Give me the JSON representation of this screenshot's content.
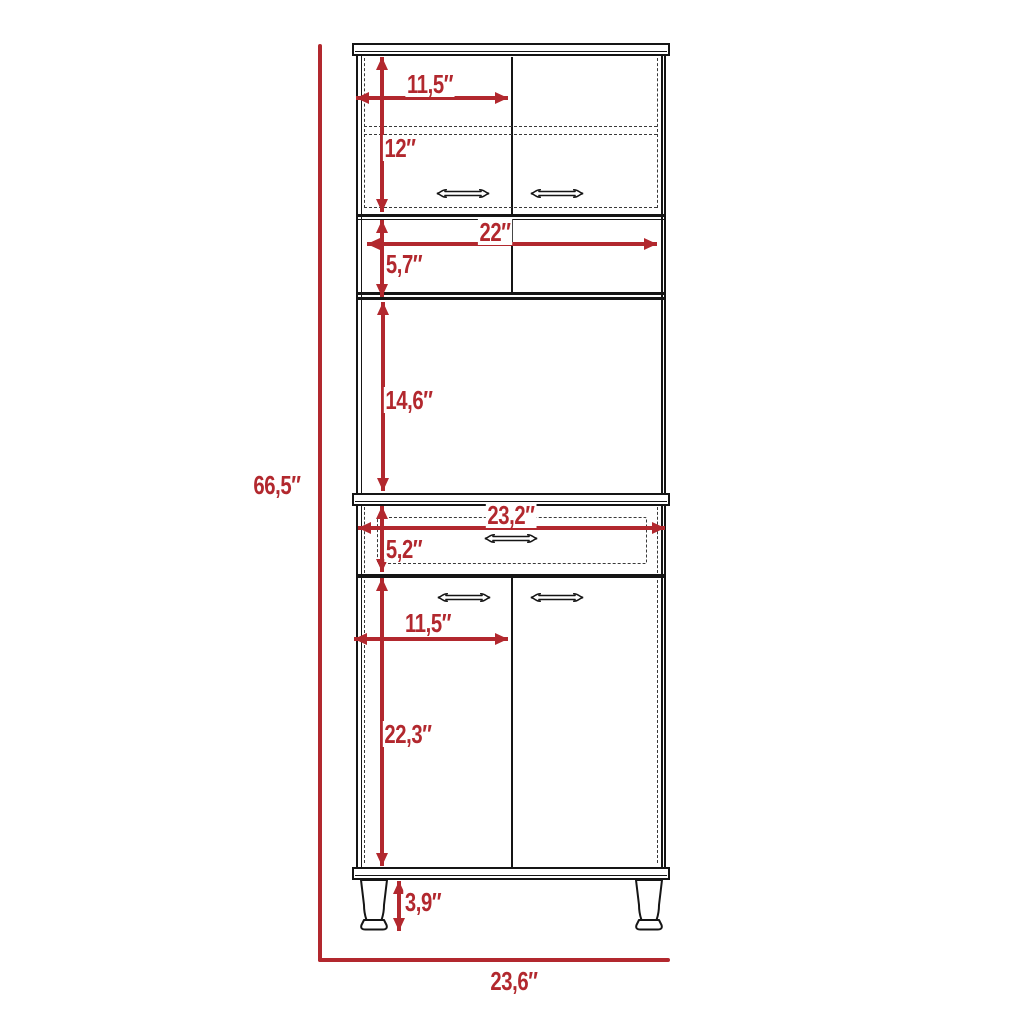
{
  "colors": {
    "dimension_red": "#B2282E",
    "outline_black": "#151515",
    "background": "#FFFFFF"
  },
  "dimensions": {
    "overall_height": "66,5″",
    "overall_width": "23,6″",
    "upper_door_width": "11,5″",
    "upper_section_height": "12″",
    "open_shelf_width": "22″",
    "open_shelf_height": "5,7″",
    "open_compartment_height": "14,6″",
    "drawer_width": "23,2″",
    "drawer_height": "5,2″",
    "lower_door_width": "11,5″",
    "lower_door_height": "22,3″",
    "leg_height": "3,9″"
  }
}
